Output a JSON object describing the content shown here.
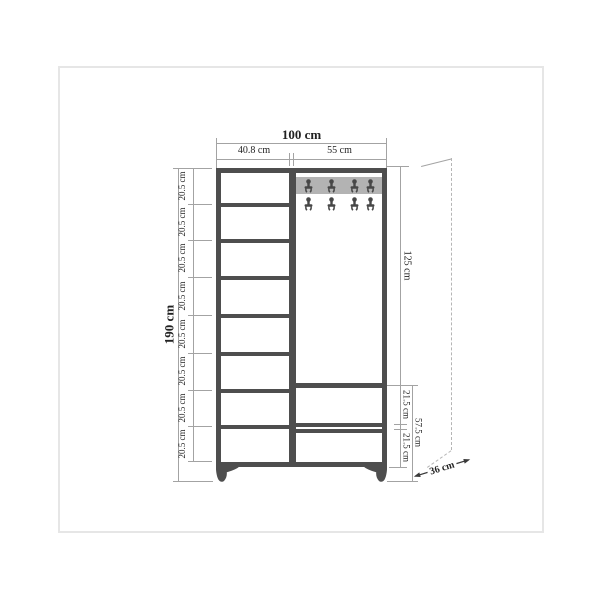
{
  "page": {
    "background": "#ffffff",
    "border_color": "#e6e6e6"
  },
  "figure": {
    "type": "furniture-dimension-diagram",
    "subject": "hallway cabinet with shelves, coat hooks and drawers (front view)"
  },
  "dimensions": {
    "top": {
      "total_width": "100 cm",
      "left_column_width": "40.8 cm",
      "right_section_width": "55 cm"
    },
    "left": {
      "total_height": "190 cm",
      "segments": [
        "20.5 cm",
        "20.5 cm",
        "20.5 cm",
        "20.5 cm",
        "20.5 cm",
        "20.5 cm",
        "20.5 cm",
        "20.5 cm"
      ]
    },
    "right": {
      "open_section_height": "125 cm",
      "drawer_heights": [
        "21.5 cm",
        "21.5 cm"
      ],
      "bottom_section_height": "57.5 cm"
    },
    "depth": "36 cm"
  },
  "cabinet": {
    "left_compartment_count": 8,
    "hook_rows": 2,
    "hooks_per_row": 4,
    "drawer_count": 2
  },
  "colors": {
    "outline": "#4e4e4e",
    "dimension_line": "#a3a3a3",
    "text": "#222222",
    "hook_rail": "#b3b3b3",
    "hook": "#474747",
    "page_border": "#e6e6e6"
  }
}
